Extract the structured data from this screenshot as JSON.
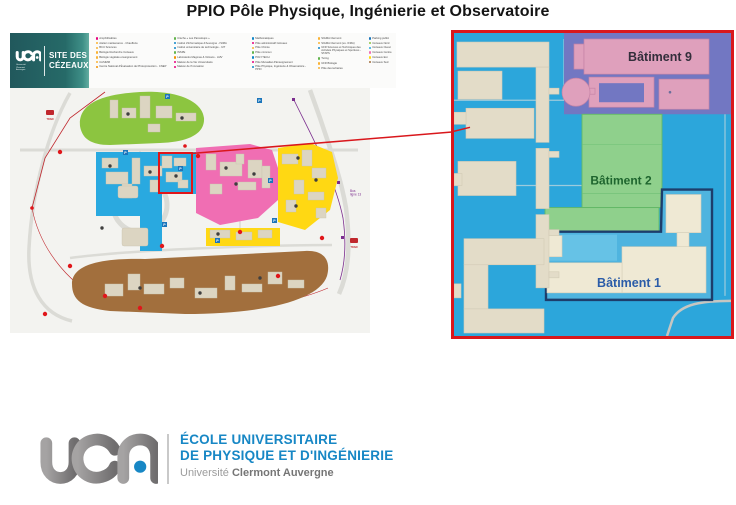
{
  "title": "PPIO Pôle Physique, Ingénierie et Observatoire",
  "campus_map": {
    "brand": {
      "logo": "uca",
      "sub_lines": [
        "Université",
        "Clermont",
        "Auvergne"
      ],
      "site_line1": "SITE DES",
      "site_line2": "CÉZEAUX"
    },
    "legend": {
      "cols": [
        {
          "items": [
            {
              "label": "Amphithéâtres",
              "dot": "#E6007E"
            },
            {
              "label": "Atelier maintenance - Chaufferie",
              "dot": "#F9B233"
            },
            {
              "label": "BCU Sciences",
              "dot": "#F9B233"
            },
            {
              "label": "Biologie Recherche Cézeaux",
              "dot": "#F9B233"
            },
            {
              "label": "Biologie végétale enseignement",
              "dot": "#F9B233"
            },
            {
              "label": "CASIMM",
              "dot": "#F9B233"
            },
            {
              "label": "Centre National d'Évaluation de Photoprotection - CNEP",
              "dot": "#F39200"
            }
          ]
        },
        {
          "items": [
            {
              "label": "Crèche « Les Parceloups »",
              "dot": "#61B44B"
            },
            {
              "label": "Institut d'Informatique d'Auvergne - ISIMA",
              "dot": "#0E86C8"
            },
            {
              "label": "Institut universitaire de technologie - IUT",
              "dot": "#0E86C8"
            },
            {
              "label": "INSPE",
              "dot": "#61B44B"
            },
            {
              "label": "Laboratoire Magmas & Volcans - LMV",
              "dot": "#F39200"
            },
            {
              "label": "Maison de la Vie Universitaire",
              "dot": "#E6007E"
            },
            {
              "label": "Maison de l'Innovation",
              "dot": "#E6007E"
            }
          ]
        },
        {
          "items": [
            {
              "label": "Mathématiques",
              "dot": "#0E86C8"
            },
            {
              "label": "Pôle administratif Cézeaux",
              "dot": "#E6007E"
            },
            {
              "label": "Pôle Chimie",
              "dot": "#F9B233"
            },
            {
              "label": "Pôle commun",
              "dot": "#61B44B"
            },
            {
              "label": "POLYTECH",
              "dot": "#0E86C8"
            },
            {
              "label": "Pôle Mutualisé d'Enseignement",
              "dot": "#E6007E"
            },
            {
              "label": "Pôle Physique, Ingénierie & Observatoire - PPIO",
              "dot": "#0E86C8"
            }
          ]
        },
        {
          "items": [
            {
              "label": "SIGMA Clermont",
              "dot": "#F9B233"
            },
            {
              "label": "SIGMA Clermont (ex. IFMA)",
              "dot": "#F9B233"
            },
            {
              "label": "UFR Sciences et Techniques des Activités Physiques et Sportives - STAPS",
              "dot": "#0E86C8"
            },
            {
              "label": "Turing",
              "dot": "#61B44B"
            },
            {
              "label": "UFR Biologie",
              "dot": "#F9B233"
            },
            {
              "label": "Pôle des tertiaires",
              "dot": "#F9B233"
            }
          ]
        },
        {
          "items": [
            {
              "label": "Parking public",
              "dot": "#1B75BB"
            },
            {
              "label": "Cézeaux Nord",
              "dot": "#8CC540"
            },
            {
              "label": "Cézeaux Ouest",
              "dot": "#29A9E0"
            },
            {
              "label": "Cézeaux Centre",
              "dot": "#F06EB3"
            },
            {
              "label": "Cézeaux Est",
              "dot": "#FFD813"
            },
            {
              "label": "Cézeaux Sud",
              "dot": "#A26F3D"
            }
          ]
        }
      ]
    },
    "map_labels": {
      "bus_line1": "Bus",
      "bus_line2": "ligne 13",
      "tram": "TRAM",
      "parking": "P"
    }
  },
  "detail_panel": {
    "building9_label": "Bâtiment 9",
    "building2_label": "Bâtiment 2",
    "building1_label": "Bâtiment 1"
  },
  "footer": {
    "school_line1": "ÉCOLE UNIVERSITAIRE",
    "school_line2": "DE PHYSIQUE ET D'INGÉNIERIE",
    "university_regular": "Université",
    "university_bold": "Clermont Auvergne"
  },
  "colors": {
    "highlight_red": "#D9171C",
    "brand_blue": "#1787C5",
    "zone_nord_green": "#8CC540",
    "zone_ouest_blue": "#29A9E0",
    "zone_centre_pink": "#F06EB3",
    "zone_est_yellow": "#FFD813",
    "zone_sud_brown": "#A26F3D",
    "panel_bg_blue": "#2CA6DB",
    "batiment9_zone_purple": "#7277C2",
    "batiment9_pink": "#DFA0BC",
    "batiment2_green": "#8FD08C",
    "header_teal": "#26696B"
  }
}
